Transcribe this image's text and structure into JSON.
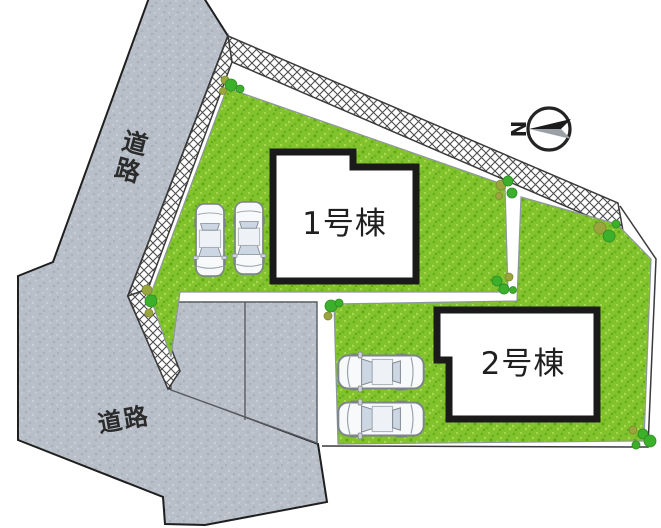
{
  "site_plan": {
    "road_labels": {
      "top": "道路",
      "bottom": "道路"
    },
    "buildings": [
      {
        "label": "1号棟"
      },
      {
        "label": "2号棟"
      }
    ],
    "compass": {
      "letter": "N"
    },
    "cars": {
      "plot1_count": 2,
      "plot2_count": 2
    },
    "colors": {
      "grass": "#82c32d",
      "road": "#b8bfc8",
      "outline": "#1f1f1f",
      "building_border": "#1a1a1a",
      "bush_green": "#3caf2b",
      "bush_olive": "#9aa53e",
      "car_window": "#ccd7e3",
      "compass_gray": "#9aa0a6"
    }
  }
}
